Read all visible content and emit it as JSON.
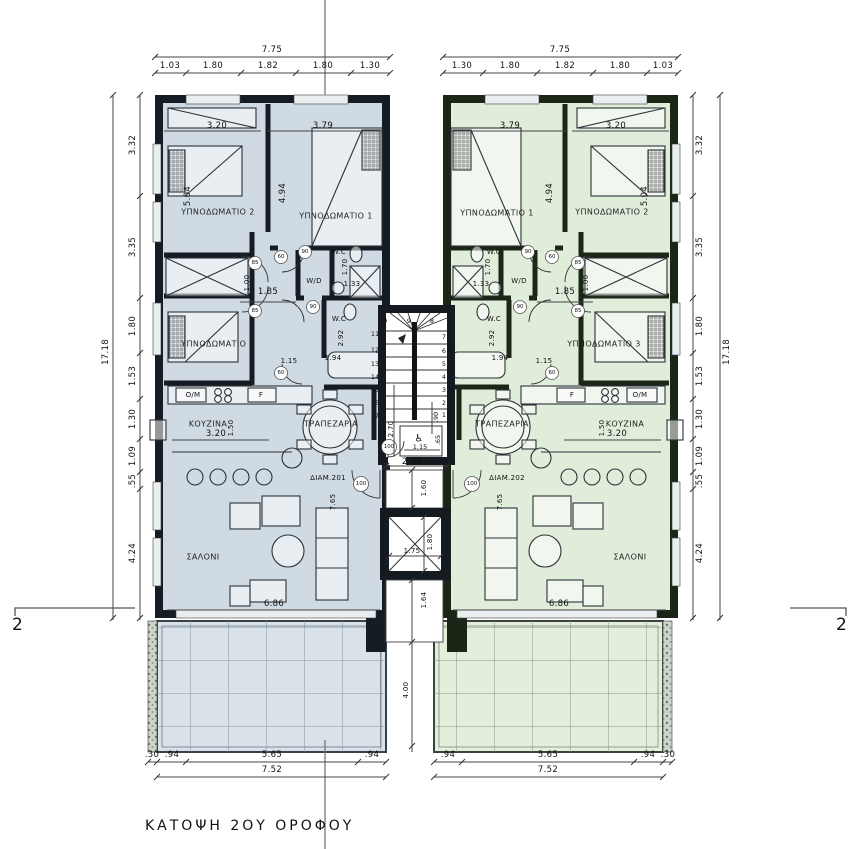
{
  "title": "ΚΑΤΟΨΗ 2ΟΥ ΟΡΟΦΟΥ",
  "section": {
    "left": "2",
    "right": "2"
  },
  "icons": {
    "wheelchair": "♿"
  },
  "rooms": {
    "bedroom1": "ΥΠΝΟΔΩΜΑΤΙΟ 1",
    "bedroom2": "ΥΠΝΟΔΩΜΑΤΙΟ 2",
    "bedroom3": "ΥΠΝΟΔΩΜΑΤΙΟ 3",
    "kitchen": "ΚΟΥΖΙΝΑ",
    "dining": "ΤΡΑΠΕΖΑΡΙΑ",
    "living": "ΣΑΛΟΝΙ",
    "wc": "W.C",
    "wd": "W/D",
    "om": "O/M",
    "f": "F"
  },
  "apartments": {
    "left_id": "ΔΙΑΜ.201",
    "right_id": "ΔΙΑΜ.202"
  },
  "dims": {
    "top_total": "7.75",
    "top_left_seg": [
      "1.03",
      "1.80",
      "1.82",
      "1.80",
      "1.30"
    ],
    "top_right_seg": [
      "1.30",
      "1.80",
      "1.82",
      "1.80",
      "1.03"
    ],
    "side_total": "17.18",
    "side_seg": [
      "3.32",
      "3.35",
      "1.80",
      "1.53",
      "1.30",
      "1.09",
      ".55",
      "4.24"
    ],
    "bottom_total": "7.52",
    "bottom_left_seg": [
      ".30",
      ".94",
      "5.65",
      ".94"
    ],
    "bottom_right_seg": [
      ".94",
      "5.65",
      ".94",
      ".30"
    ],
    "bed2_w": "3.20",
    "bed1_w": "3.79",
    "bed2_d": "5.04",
    "bed1_d": "4.94",
    "hall_w": "1.85",
    "hall_d": "1.00",
    "wc1_d": "1.70",
    "wc1_w": "1.33",
    "wc2_d": "2.92",
    "wc2_w": "1.94",
    "pass": "1.15",
    "kitchen_w": "3.20",
    "kitchen_d": "1.50",
    "living_w": "6.86",
    "living_d": "7.65",
    "landing_w": "2.50",
    "stair_d": "2.70",
    "wc_core_w": "1.15",
    "wc_core_d": ".65",
    "wc_core_s": ".90",
    "well_top": "1.60",
    "elev_w": "1.75",
    "elev_d": "1.80",
    "well_bottom": "1.64",
    "balcony_gap": "4.00"
  },
  "doors": {
    "d60": "60",
    "d85": "85",
    "d90": "90",
    "d100": "100"
  },
  "stairs": {
    "top": [
      "10",
      "9",
      "8"
    ],
    "left": [
      "11",
      "12",
      "13",
      "14",
      "15",
      "16",
      "17"
    ],
    "right": [
      "7",
      "6",
      "5",
      "4",
      "3",
      "2",
      "1"
    ]
  },
  "colors": {
    "left_floor": "#cfdae3",
    "right_floor": "#e0eddb",
    "left_wall": "#151c23",
    "right_wall": "#1b2617",
    "left_balcony": "#d9e2e9",
    "right_balcony": "#e3efdc",
    "dim_line": "#444444"
  }
}
